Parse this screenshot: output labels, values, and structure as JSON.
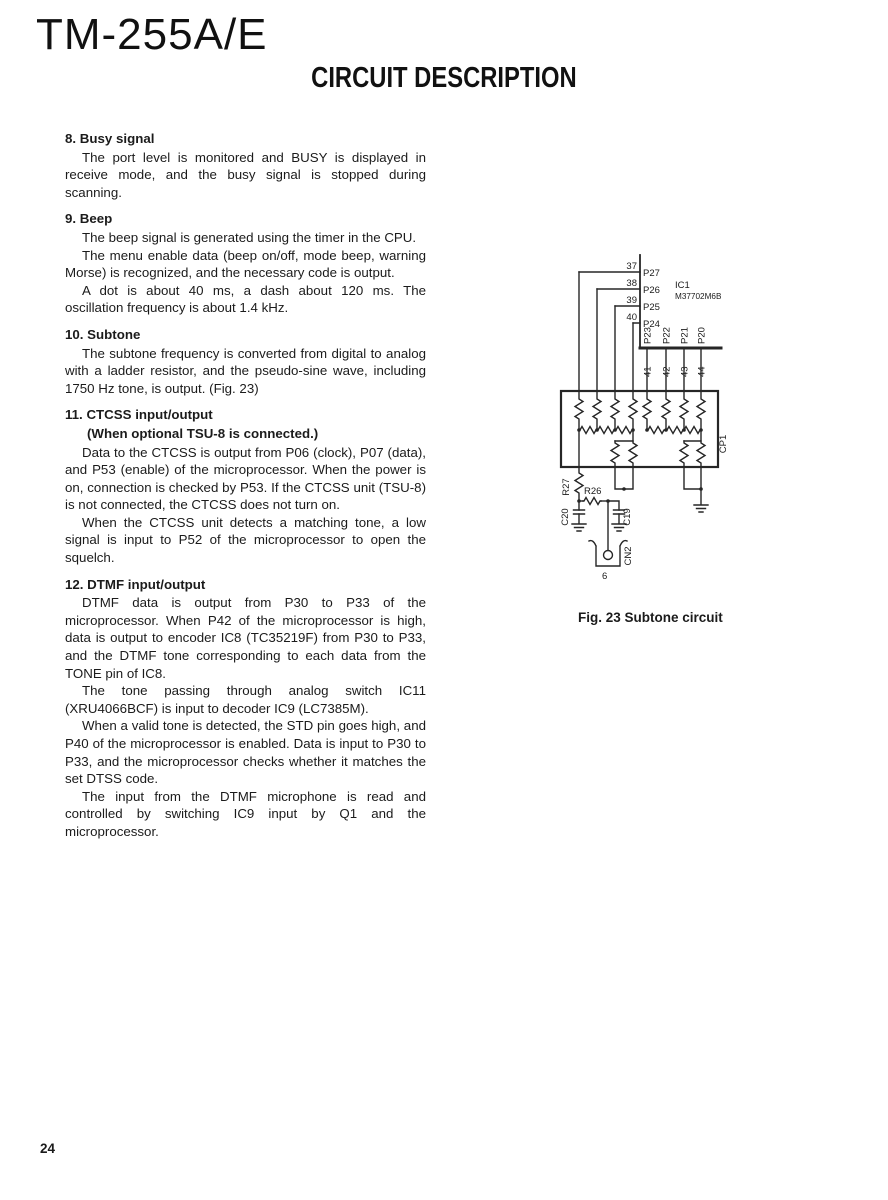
{
  "page": {
    "model": "TM-255A/E",
    "title": "CIRCUIT DESCRIPTION",
    "page_number": "24"
  },
  "sections": [
    {
      "heading": "8. Busy signal",
      "paragraphs": [
        "The port level is monitored and BUSY is displayed in receive mode, and the busy signal is stopped during scanning."
      ]
    },
    {
      "heading": "9. Beep",
      "paragraphs": [
        "The beep signal is generated using the timer in the CPU.",
        "The menu enable data (beep on/off, mode beep, warning Morse) is recognized, and the necessary code is output.",
        "A dot is about 40 ms, a dash about 120 ms.  The oscillation frequency is about 1.4 kHz."
      ]
    },
    {
      "heading": "10. Subtone",
      "paragraphs": [
        "The subtone frequency is converted from digital to analog with a ladder resistor, and the pseudo-sine wave, including 1750 Hz tone, is output. (Fig. 23)"
      ]
    },
    {
      "heading": "11. CTCSS input/output",
      "subheading": "(When optional TSU-8 is connected.)",
      "paragraphs": [
        "Data to the CTCSS is output from P06 (clock), P07 (data), and P53 (enable) of the microprocessor. When the power is on, connection is checked by P53. If the CTCSS unit (TSU-8) is not connected, the CTCSS does not turn on.",
        "When the CTCSS unit detects a matching tone, a low signal is input to P52 of the microprocessor to open the squelch."
      ]
    },
    {
      "heading": "12. DTMF input/output",
      "paragraphs": [
        "DTMF data is output from P30 to P33 of the microprocessor. When P42 of the microprocessor is high, data is output to encoder IC8 (TC35219F) from P30 to P33, and the DTMF tone corresponding to each data from the TONE pin of IC8.",
        "The tone passing through analog switch IC11 (XRU4066BCF) is input to decoder IC9 (LC7385M).",
        "When a valid tone is detected, the STD pin goes high, and P40 of the microprocessor is enabled. Data is input to P30 to P33, and the microprocessor checks whether it matches the set DTSS code.",
        "The input from the DTMF microphone is read and controlled by switching IC9 input by Q1 and the microprocessor."
      ]
    }
  ],
  "figure": {
    "caption": "Fig. 23 Subtone circuit",
    "ic": {
      "ref": "IC1",
      "part": "M37702M6B"
    },
    "left_pins": [
      {
        "num": "37",
        "name": "P27"
      },
      {
        "num": "38",
        "name": "P26"
      },
      {
        "num": "39",
        "name": "P25"
      },
      {
        "num": "40",
        "name": "P24"
      }
    ],
    "bottom_pins": [
      {
        "num": "41",
        "name": "P23"
      },
      {
        "num": "42",
        "name": "P22"
      },
      {
        "num": "43",
        "name": "P21"
      },
      {
        "num": "44",
        "name": "P20"
      }
    ],
    "network": "CP1",
    "r27": "R27",
    "r26": "R26",
    "c20": "C20",
    "c19": "C19",
    "cn2": "CN2",
    "cn2_pin": "6"
  }
}
